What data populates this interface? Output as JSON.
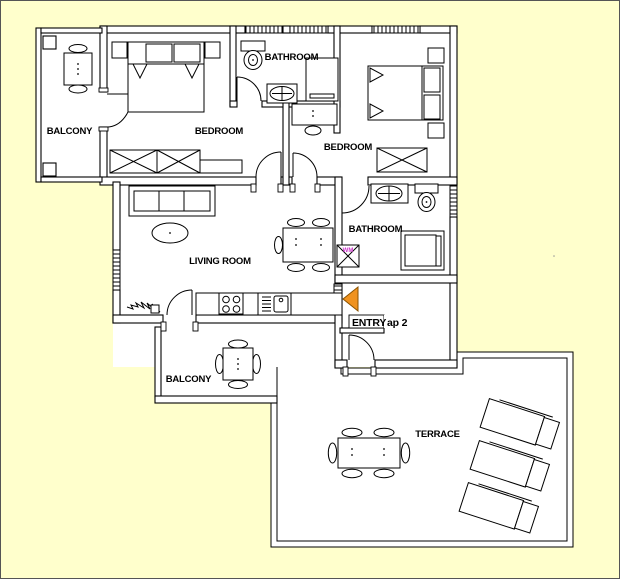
{
  "colors": {
    "background": "#FFFFCC",
    "floor": "#FFFFFF",
    "wall_line": "#000000",
    "entry_arrow_fill": "#F0921E",
    "entry_arrow_outline": "#8A5200",
    "wm_label_color": "#CC33CC"
  },
  "rooms": {
    "balcony_top": {
      "label": "BALCONY"
    },
    "bedroom_left": {
      "label": "BEDROOM"
    },
    "bathroom_top": {
      "label": "BATHROOM"
    },
    "bedroom_right": {
      "label": "BEDROOM"
    },
    "bathroom_middle": {
      "label": "BATHROOM"
    },
    "living_room": {
      "label": "LIVING ROOM"
    },
    "entry": {
      "label": "ENTRY",
      "unit": "ap 2"
    },
    "balcony_bottom": {
      "label": "BALCONY"
    },
    "terrace": {
      "label": "TERRACE"
    }
  },
  "appliances": {
    "washing_machine_label": "WM"
  }
}
